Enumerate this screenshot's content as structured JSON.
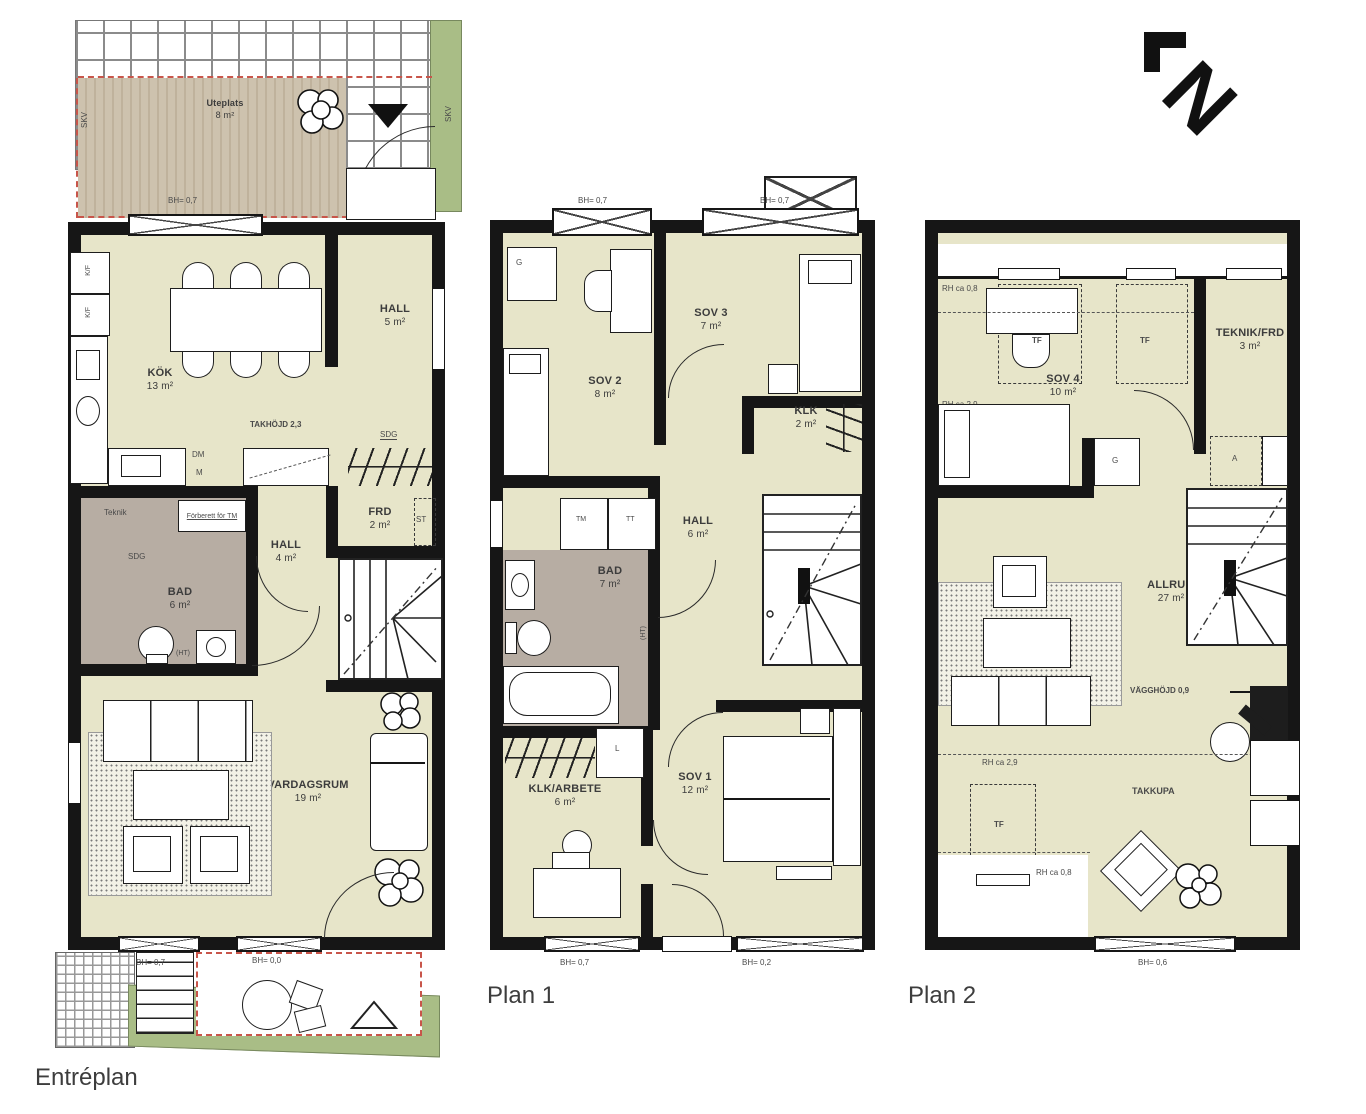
{
  "palette": {
    "floor": "#e7e5c9",
    "wet_room": "#b7ada3",
    "deck": "#cbc0ac",
    "garden": "#a9bd86",
    "wall": "#161616",
    "red_boundary": "#c8554a"
  },
  "compass": {
    "label": "N"
  },
  "entreplan": {
    "title": "Entréplan",
    "uteplats": {
      "name": "Uteplats",
      "area": "8 m²"
    },
    "skv_left": "SKV",
    "skv_right": "SKV",
    "bh_top": "BH= 0,7",
    "kok": {
      "name": "KÖK",
      "area": "13 m²"
    },
    "hall_upper": {
      "name": "HALL",
      "area": "5 m²"
    },
    "kf1": "K/F",
    "kf2": "K/F",
    "dm": "DM",
    "m": "M",
    "takhojd": "TAKHÖJD 2,3",
    "sdg_hall": "SDG",
    "teknik": "Teknik",
    "forberett": "Förberett för TM",
    "sdg_bad": "SDG",
    "bad": {
      "name": "BAD",
      "area": "6 m²"
    },
    "hall_lower": {
      "name": "HALL",
      "area": "4 m²"
    },
    "frd": {
      "name": "FRD",
      "area": "2 m²"
    },
    "st": "ST",
    "ht": "(HT)",
    "vardagsrum": {
      "name": "VARDAGSRUM",
      "area": "19 m²"
    },
    "bh_bottom_left": "BH= 0,7",
    "bh_bottom_right": "BH= 0,0"
  },
  "plan1": {
    "title": "Plan 1",
    "bh_top_left": "BH= 0,7",
    "bh_top_right": "BH= 0,7",
    "g": "G",
    "sov2": {
      "name": "SOV 2",
      "area": "8 m²"
    },
    "sov3": {
      "name": "SOV 3",
      "area": "7 m²"
    },
    "klk": {
      "name": "KLK",
      "area": "2 m²"
    },
    "hall": {
      "name": "HALL",
      "area": "6 m²"
    },
    "bad": {
      "name": "BAD",
      "area": "7 m²"
    },
    "tm": "TM",
    "tt": "TT",
    "ht": "(HT)",
    "l": "L",
    "klk_arbete": {
      "name": "KLK/ARBETE",
      "area": "6 m²"
    },
    "sov1": {
      "name": "SOV 1",
      "area": "12 m²"
    },
    "bh_bottom_left": "BH= 0,7",
    "bh_bottom_right": "BH= 0,2"
  },
  "plan2": {
    "title": "Plan 2",
    "rh_top": "RH ca 0,8",
    "tf1": "TF",
    "tf2": "TF",
    "tf3": "TF",
    "teknik_frd": {
      "name": "TEKNIK/FRD",
      "area": "3 m²"
    },
    "sov4": {
      "name": "SOV 4",
      "area": "10 m²"
    },
    "rh_mid": "RH ca 2,9",
    "g": "G",
    "a": "A",
    "allrum": {
      "name": "ALLRUM",
      "area": "27 m²"
    },
    "vagghojd": "VÄGGHÖJD 0,9",
    "rh_lower": "RH ca 2,9",
    "takkupa": "TAKKUPA",
    "rh_bottom": "RH ca 0,8",
    "bh_bottom": "BH= 0,6"
  }
}
